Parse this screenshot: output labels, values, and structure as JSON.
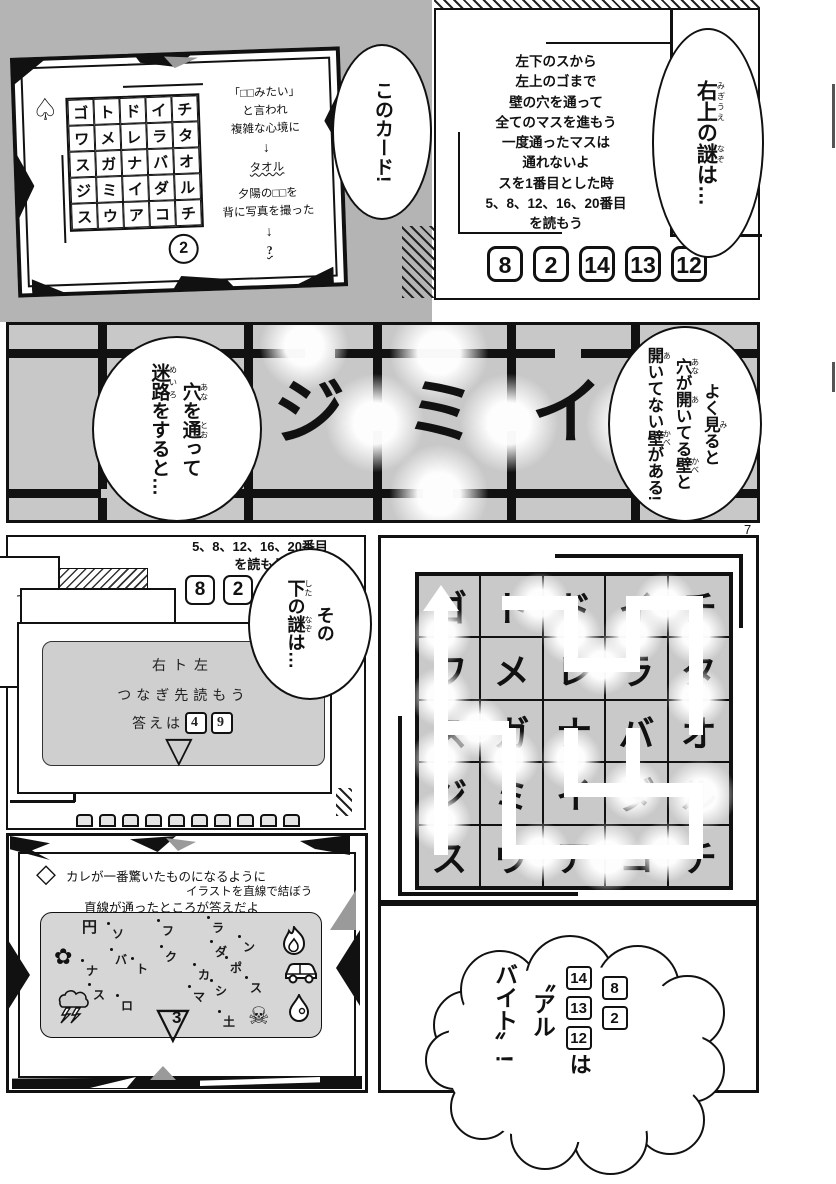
{
  "page": {
    "number": "7",
    "bg_color": "#b4b4b4",
    "band_bg": "#c8c8c8",
    "cell_gray": "#c9c9c9"
  },
  "card": {
    "suit": "♤",
    "grid": [
      [
        "ゴ",
        "ト",
        "ド",
        "イ",
        "チ"
      ],
      [
        "ワ",
        "メ",
        "レ",
        "ラ",
        "タ"
      ],
      [
        "ス",
        "ガ",
        "ナ",
        "バ",
        "オ"
      ],
      [
        "ジ",
        "ミ",
        "イ",
        "ダ",
        "ル"
      ],
      [
        "ス",
        "ウ",
        "ア",
        "コ",
        "チ"
      ]
    ],
    "clue1": [
      "「□□みたい」",
      "と言われ",
      "複雑な心境に"
    ],
    "arrow1": "↓",
    "answer1": "タオル",
    "clue2": [
      "夕陽の□□を",
      "背に写真を撮った"
    ],
    "arrow2": "↓",
    "answer2": "?",
    "number": "2"
  },
  "rules": {
    "lines": [
      "左下のスから",
      "左上のゴまで",
      "壁の穴を通って",
      "全てのマスを進もう",
      "一度通ったマスは",
      "通れないよ",
      "スを1番目とした時",
      "5、8、12、16、20番目",
      "を読もう"
    ],
    "numbers": [
      "8",
      "2",
      "14",
      "13",
      "12"
    ]
  },
  "bubbles": {
    "this_card": "このカード!",
    "top_right": [
      [
        "右上",
        "みぎうえ"
      ],
      [
        "の",
        null
      ],
      [
        "謎",
        "なぞ"
      ],
      [
        "は…",
        null
      ]
    ],
    "maze_left": [
      [
        [
          "穴",
          "あな"
        ],
        [
          "を",
          null
        ],
        [
          "通",
          "とお"
        ],
        [
          "って",
          null
        ]
      ],
      [
        [
          "迷路",
          "めいろ"
        ],
        [
          "をすると…",
          null
        ]
      ]
    ],
    "maze_right": [
      [
        [
          "よく",
          null
        ],
        [
          "見",
          "み"
        ],
        [
          "ると",
          null
        ]
      ],
      [
        [
          "穴",
          "あな"
        ],
        [
          "が",
          null
        ],
        [
          "開",
          "あ"
        ],
        [
          "いてる",
          null
        ],
        [
          "壁",
          "かべ"
        ],
        [
          "と",
          null
        ]
      ],
      [
        [
          "開",
          "あ"
        ],
        [
          "いてない",
          null
        ],
        [
          "壁",
          "かべ"
        ],
        [
          "がある!",
          null
        ]
      ]
    ],
    "next": [
      [
        [
          "その",
          null
        ]
      ],
      [
        [
          "下",
          "した"
        ],
        [
          "の",
          null
        ],
        [
          "謎",
          "なぞ"
        ],
        [
          "は…",
          null
        ]
      ]
    ]
  },
  "band": {
    "chars": [
      "ジ",
      "ミ",
      "イ"
    ]
  },
  "mid_left": {
    "snippet": [
      "5、8、12、16、20番目",
      "を読もう"
    ],
    "numbers": [
      "8",
      "2",
      "14"
    ],
    "partial": "で",
    "gray_card": {
      "line1": "右ト左",
      "line2": "つなぎ先読もう",
      "answer_prefix": "答えは",
      "answers": [
        "4",
        "9"
      ],
      "triangle": "▽"
    }
  },
  "maze_grid": {
    "grid": [
      [
        "ゴ",
        "ト",
        "ド",
        "イ",
        "チ"
      ],
      [
        "ワ",
        "メ",
        "レ",
        "ラ",
        "タ"
      ],
      [
        "ス",
        "ガ",
        "ナ",
        "バ",
        "オ"
      ],
      [
        "ジ",
        "ミ",
        "イ",
        "ダ",
        "ル"
      ],
      [
        "ス",
        "ウ",
        "ア",
        "コ",
        "チ"
      ]
    ]
  },
  "bottom_left": {
    "suit": "◇",
    "lines": [
      "カレが一番驚いたものになるように",
      "イラストを直線で結ぼう",
      "直線が通ったところが答えだよ"
    ],
    "scatter": [
      {
        "ch": "円"
      },
      {
        "ch": "ソ"
      },
      {
        "ch": "フ"
      },
      {
        "ch": "ラ"
      },
      {
        "ch": "ン"
      },
      {
        "ch": "ダ"
      },
      {
        "ch": "ク"
      },
      {
        "ch": "バ"
      },
      {
        "ch": "ト"
      },
      {
        "ch": "ナ"
      },
      {
        "ch": "ポ"
      },
      {
        "ch": "カ"
      },
      {
        "ch": "シ"
      },
      {
        "ch": "マ"
      },
      {
        "ch": "ス"
      },
      {
        "ch": "ス"
      },
      {
        "ch": "ロ"
      },
      {
        "ch": "土"
      }
    ],
    "icons": [
      "flower-icon",
      "fire-icon",
      "car-icon",
      "skull-icon",
      "water-drop-icon",
      "storm-icon"
    ],
    "flower": "✿",
    "skull": "☠",
    "triangle": "▽",
    "triangle_number": "3"
  },
  "cloud": {
    "boxes_col1": [
      "8",
      "2"
    ],
    "boxes_col2": [
      "14",
      "13",
      "12"
    ],
    "suffix": "は",
    "col3": "〝アル",
    "col4": "バイト〟!"
  }
}
